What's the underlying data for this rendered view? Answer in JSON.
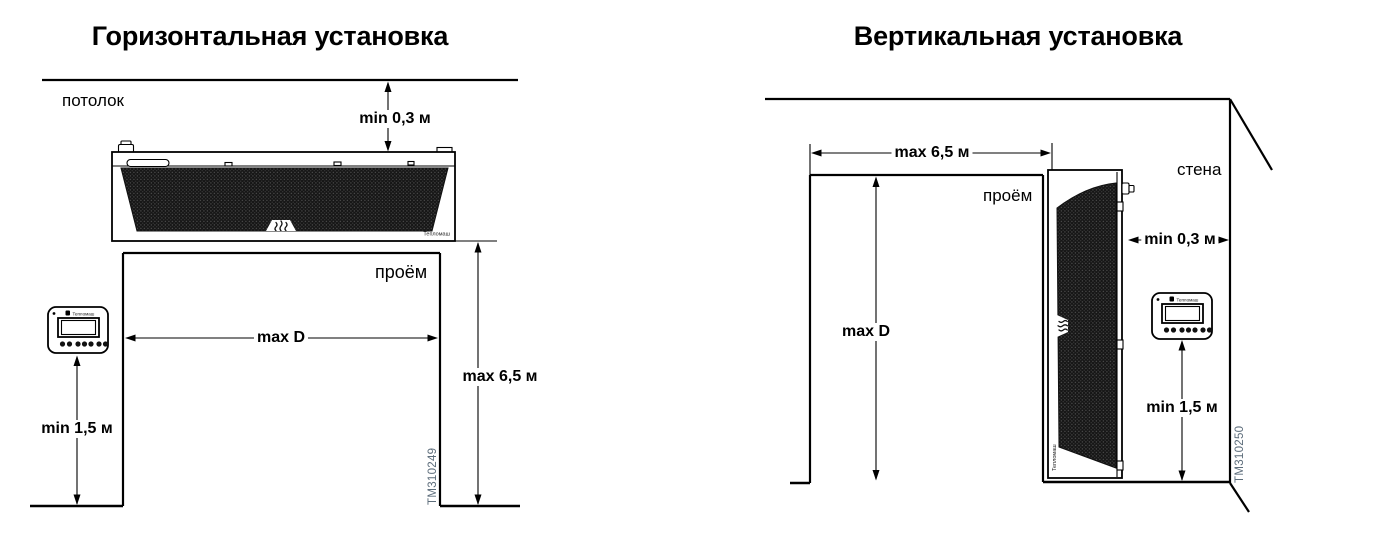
{
  "left_diagram": {
    "title": "Горизонтальная установка",
    "ceiling_label": "потолок",
    "opening_label": "проём",
    "dims": {
      "ceiling_gap": "min 0,3 м",
      "opening_width": "max D",
      "opening_height": "max 6,5 м",
      "controller_height": "min 1,5 м"
    },
    "drawing_id": "ТМ310249"
  },
  "right_diagram": {
    "title": "Вертикальная установка",
    "wall_label": "стена",
    "opening_label": "проём",
    "dims": {
      "opening_width": "max 6,5 м",
      "wall_gap": "min 0,3 м",
      "opening_height": "max D",
      "controller_height": "min 1,5 м"
    },
    "drawing_id": "ТМ310250"
  },
  "device": {
    "brand": "Тепломаш"
  },
  "colors": {
    "line": "#000000",
    "drawing_id_text": "#5d6d7b",
    "grille": "#161616"
  }
}
